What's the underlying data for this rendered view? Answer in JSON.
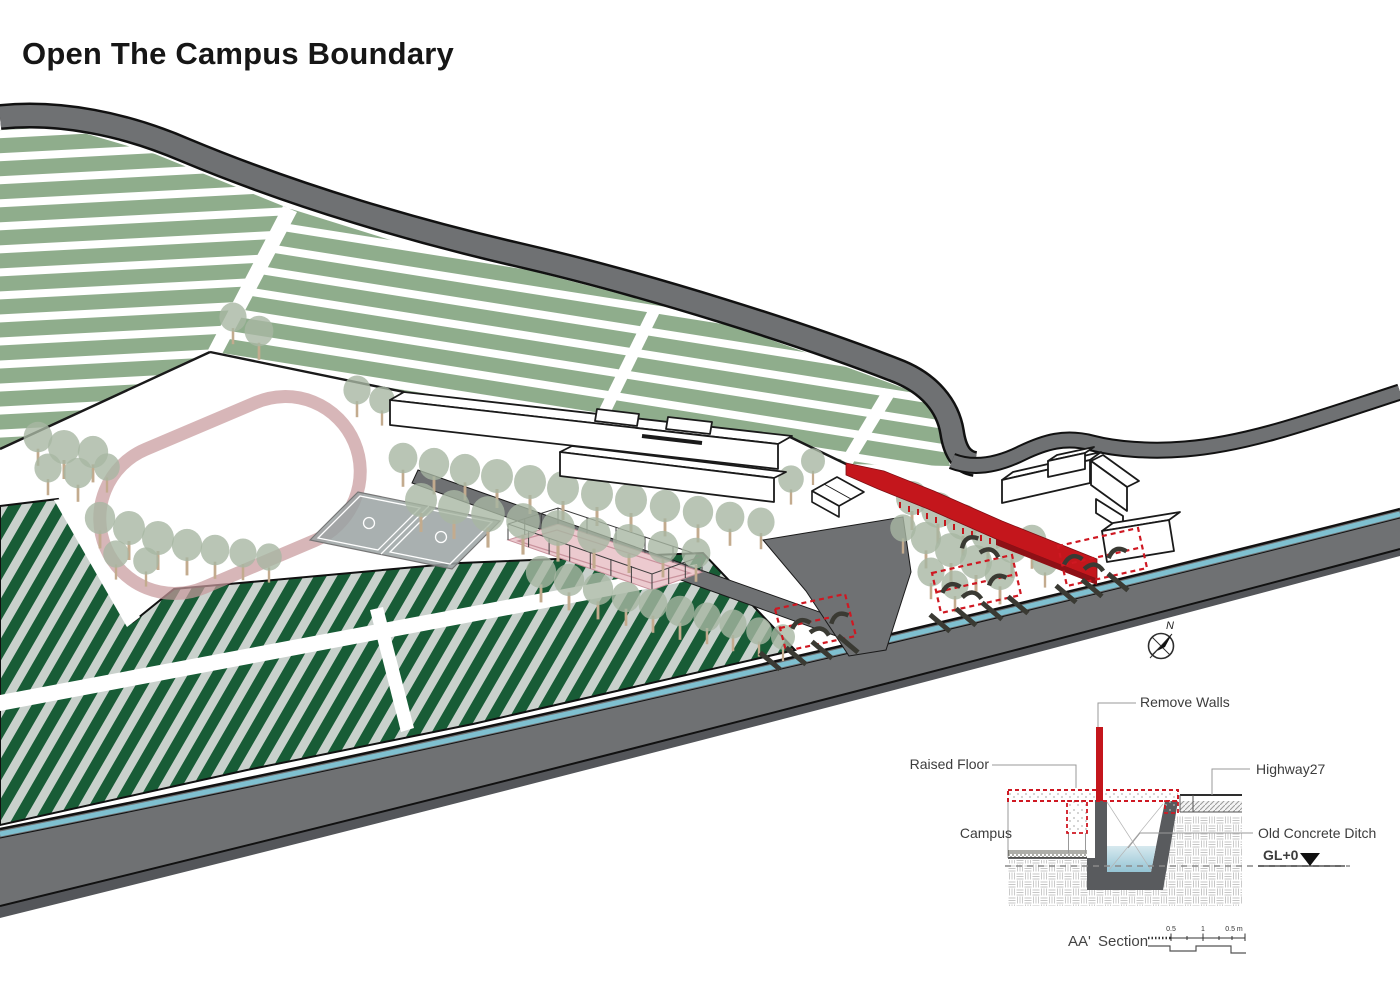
{
  "title": "Open The Campus Boundary",
  "map": {
    "compass_label": "N"
  },
  "colors": {
    "accent_red": "#c4161c",
    "dark_red": "#8e1016",
    "farmland_green": "#8fad8c",
    "field_green": "#185c36",
    "field_light": "#c9d1cc",
    "road_gray": "#6f7173",
    "road_dark": "#54565a",
    "ditch_water": "#7fc0d0",
    "track_pink": "#c79a9d",
    "tree_green": "#a8b6a3",
    "court_gray": "#9aa2a2",
    "court_pink": "#eccacf",
    "bench_dark": "#3a3a33"
  },
  "section_detail": {
    "labels": {
      "remove_walls": "Remove Walls",
      "raised_floor": "Raised Floor",
      "campus": "Campus",
      "highway": "Highway27",
      "old_concrete_ditch": "Old Concrete Ditch",
      "ground_level": "GL+0"
    },
    "caption": {
      "name": "AA'",
      "kind": "Section"
    },
    "scale_ticks": [
      "0.5",
      "1",
      "0.5 m"
    ]
  }
}
